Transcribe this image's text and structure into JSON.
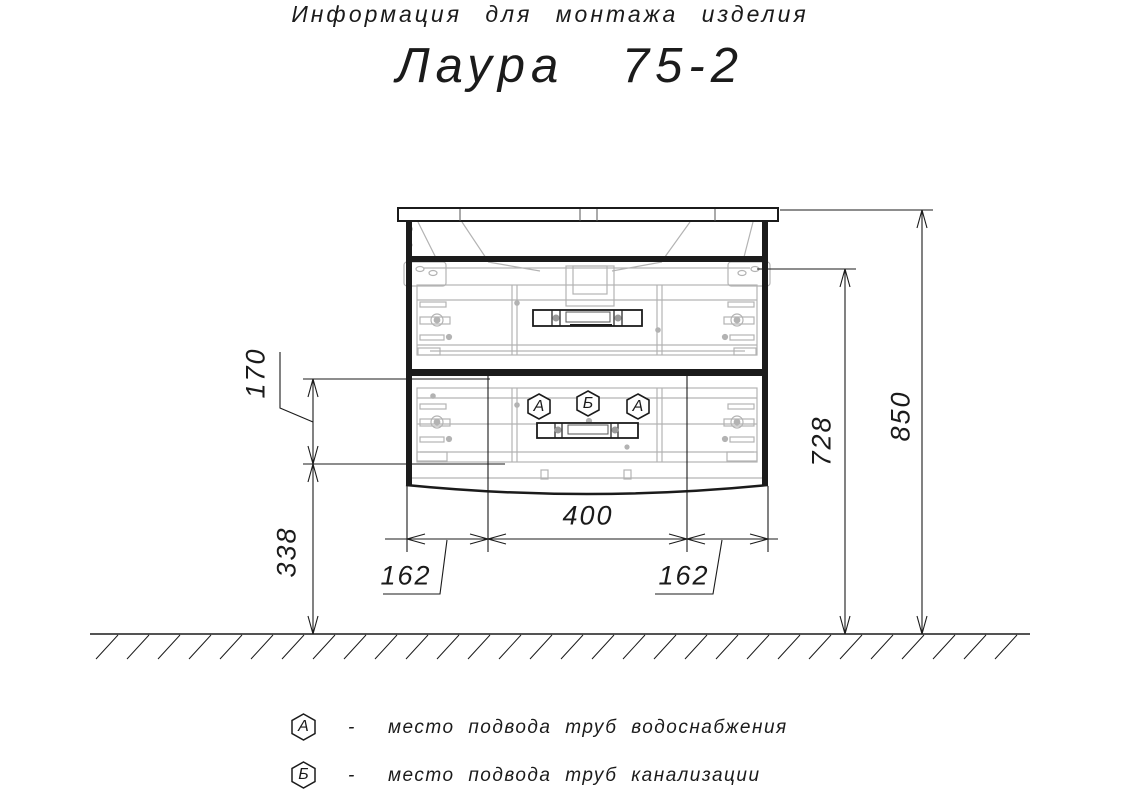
{
  "title": {
    "subtitle": "Информация для монтажа изделия",
    "product": "Лаура  75-2"
  },
  "dimensions": {
    "front_height": "170",
    "floor_clearance": "338",
    "center_width": "400",
    "left_offset": "162",
    "right_offset": "162",
    "mount_height": "728",
    "total_height": "850"
  },
  "markers": {
    "a1": "А",
    "b": "Б",
    "a2": "А"
  },
  "legend": {
    "water": {
      "symbol": "А",
      "dash": "-",
      "text": "место подвода труб водоснабжения"
    },
    "sewer": {
      "symbol": "Б",
      "dash": "-",
      "text": "место подвода труб канализации"
    }
  },
  "colors": {
    "line": "#1b1b1b",
    "detail": "#b3b3b3"
  }
}
